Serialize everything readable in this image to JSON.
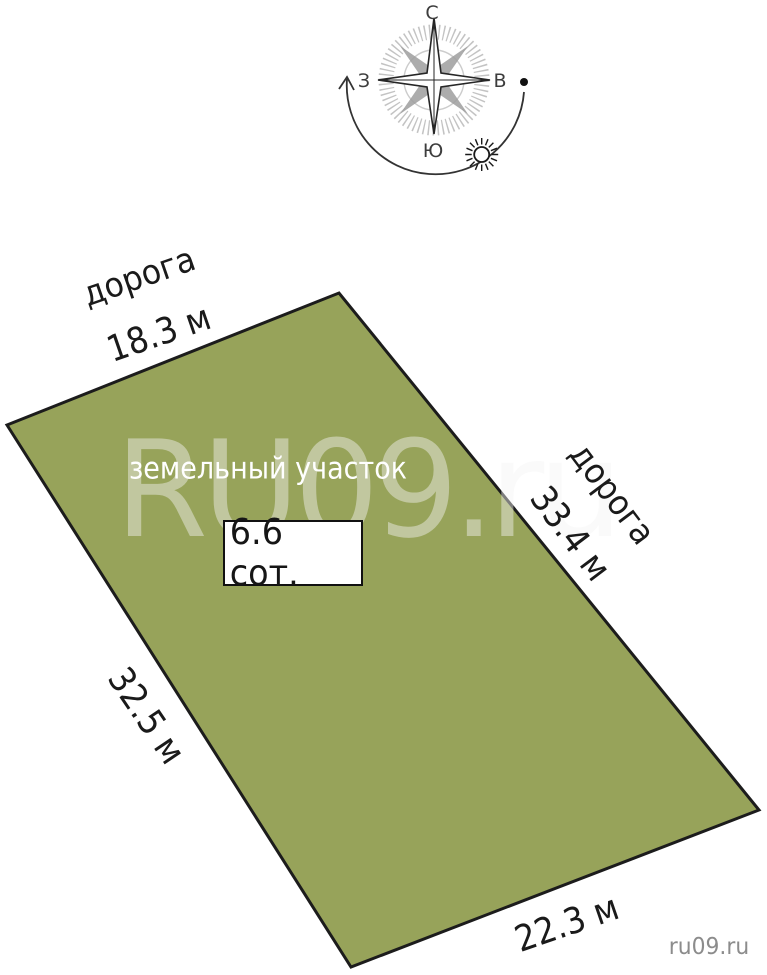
{
  "diagram": {
    "plot": {
      "label": "земельный участок",
      "area": "6.6 сот.",
      "fill_color": "#97a35a",
      "outline_color": "#1c1c1c"
    },
    "roads": {
      "top": "дорога",
      "right": "дорога"
    },
    "dimensions": {
      "top": "18.3 м",
      "right": "33.4 м",
      "left": "32.5 м",
      "bottom": "22.3 м"
    },
    "compass": {
      "north": "С",
      "south": "Ю",
      "west": "З",
      "east": "В"
    },
    "watermark": "RU09.ru",
    "credit": "ru09.ru",
    "colors": {
      "text": "#1a1a1a",
      "credit": "#8c8c8c",
      "white_text": "#ffffff"
    }
  }
}
